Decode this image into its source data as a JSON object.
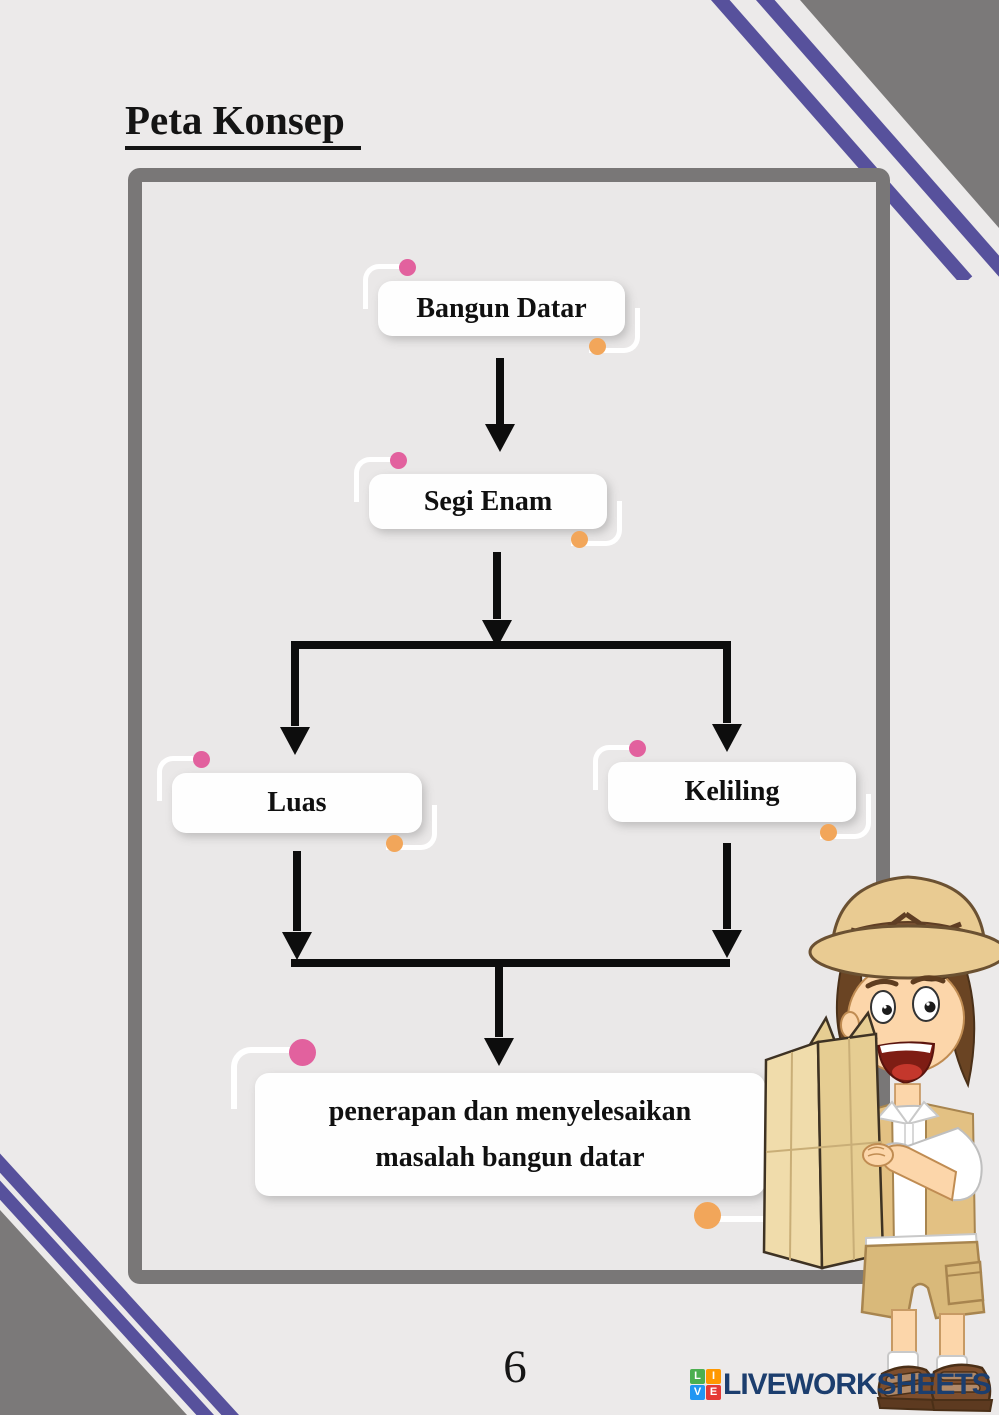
{
  "page": {
    "title": "Peta Konsep",
    "page_number": "6"
  },
  "concept_map": {
    "nodes": [
      {
        "id": "bangun-datar",
        "label": "Bangun Datar"
      },
      {
        "id": "segi-enam",
        "label": "Segi Enam"
      },
      {
        "id": "luas",
        "label": "Luas"
      },
      {
        "id": "keliling",
        "label": "Keliling"
      },
      {
        "id": "penerapan",
        "label": "penerapan dan menyelesaikan masalah bangun datar"
      }
    ],
    "edges": [
      {
        "from": "Bangun Datar",
        "to": "Segi Enam"
      },
      {
        "from": "Segi Enam",
        "to": "Luas"
      },
      {
        "from": "Segi Enam",
        "to": "Keliling"
      },
      {
        "from": "Luas",
        "to": "penerapan dan menyelesaikan masalah bangun datar"
      },
      {
        "from": "Keliling",
        "to": "penerapan dan menyelesaikan masalah bangun datar"
      }
    ]
  },
  "footer": {
    "brand": "LIVEWORKSHEETS",
    "logo_letters": [
      "L",
      "I",
      "V",
      "E"
    ]
  },
  "illustration": {
    "name": "explorer-boy-reading-map"
  },
  "colors": {
    "background": "#eceaea",
    "frame_gray": "#797777",
    "corner_gray": "#7b7979",
    "stripe_purple": "#57519c",
    "accent_pink": "#e2619e",
    "accent_orange": "#f2a65a",
    "brand_navy": "#1c3e6e"
  }
}
